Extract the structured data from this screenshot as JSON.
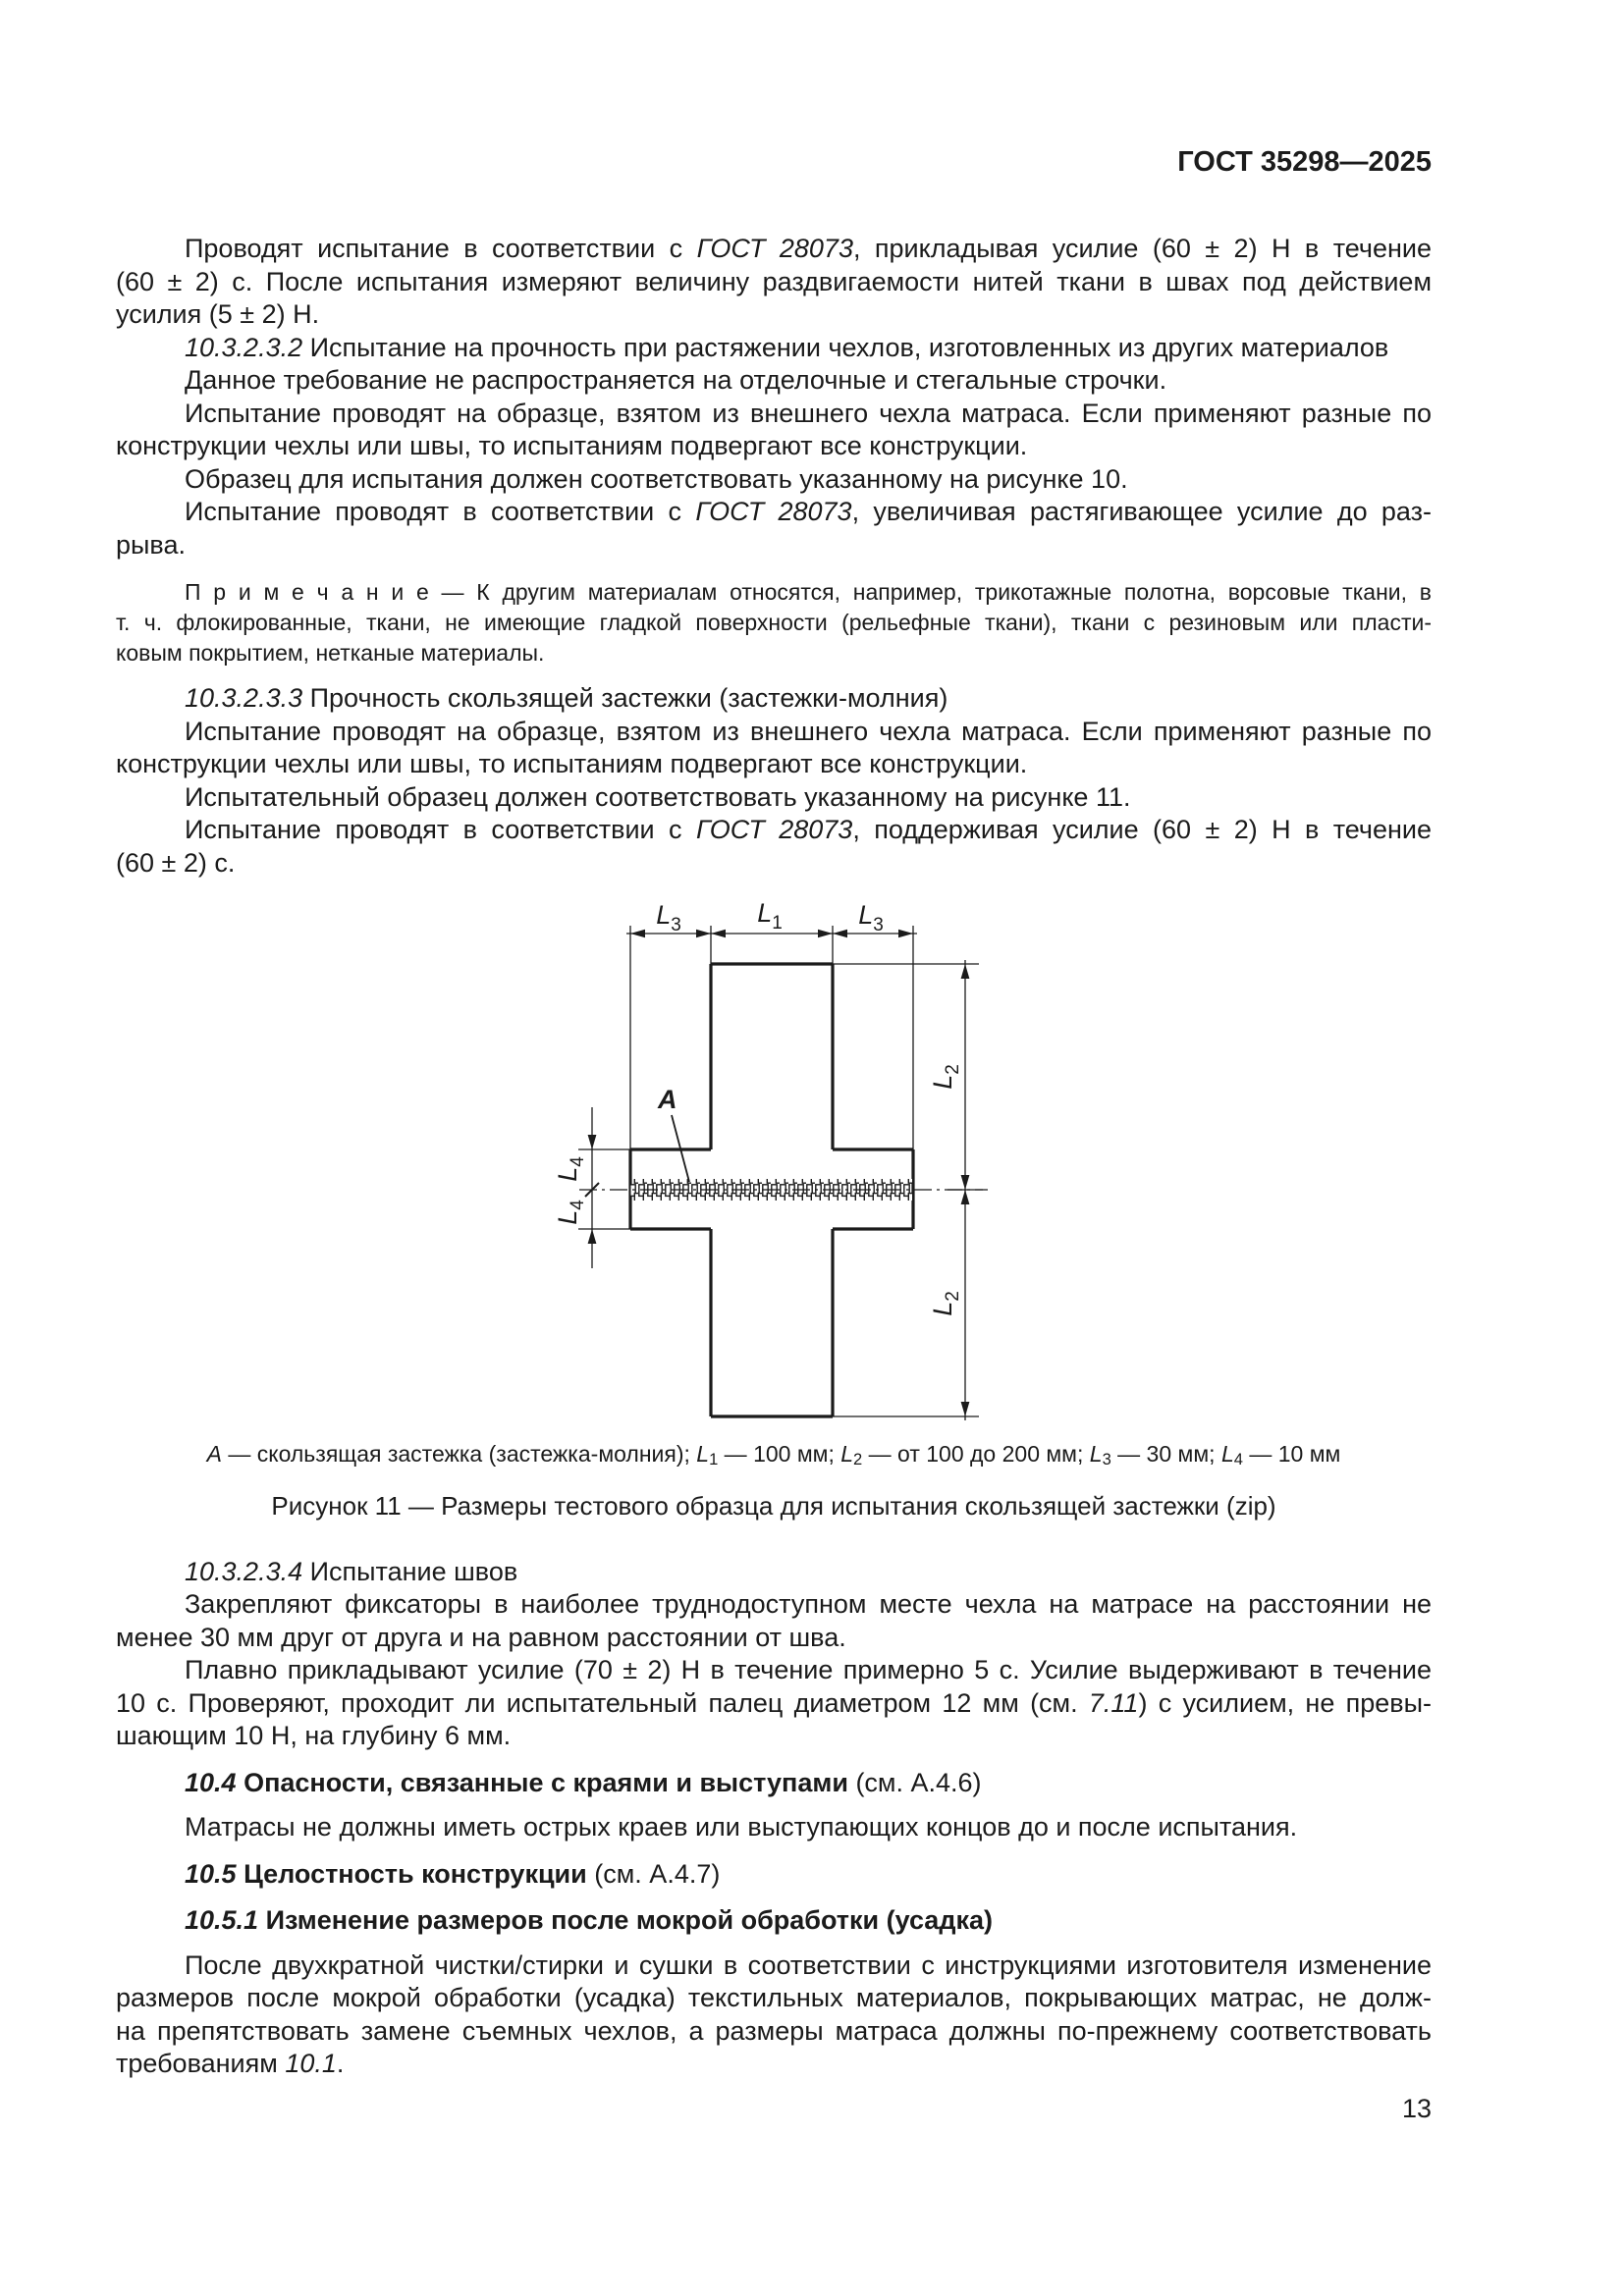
{
  "page": {
    "header_right": "ГОСТ 35298—2025",
    "page_number": "13"
  },
  "document": {
    "before_figure": [
      {
        "type": "p",
        "lines": [
          [
            [
              "r",
              "Проводят испытание в соответствии с "
            ],
            [
              "i",
              "ГОСТ 28073"
            ],
            [
              "r",
              ", прикладывая усилие (60 ± 2) Н в течение"
            ]
          ],
          [
            [
              "r",
              "(60 ± 2) с. После испытания измеряют величину раздвигаемости нитей ткани в швах под действием"
            ]
          ],
          [
            [
              "r",
              "усилия (5 ± 2) Н."
            ]
          ]
        ]
      },
      {
        "type": "p",
        "lines": [
          [
            [
              "i",
              "10.3.2.3.2"
            ],
            [
              "r",
              "  Испытание на прочность при растяжении чехлов, изготовленных из других материалов"
            ]
          ]
        ]
      },
      {
        "type": "p",
        "lines": [
          [
            [
              "r",
              "Данное требование не распространяется на отделочные и стегальные строчки."
            ]
          ]
        ]
      },
      {
        "type": "p",
        "lines": [
          [
            [
              "r",
              "Испытание проводят на образце, взятом из внешнего чехла матраса. Если применяют разные по"
            ]
          ],
          [
            [
              "r",
              "конструкции чехлы или швы, то испытаниям подвергают все конструкции."
            ]
          ]
        ]
      },
      {
        "type": "p",
        "lines": [
          [
            [
              "r",
              "Образец для испытания должен соответствовать указанному на рисунке 10."
            ]
          ]
        ]
      },
      {
        "type": "p",
        "lines": [
          [
            [
              "r",
              "Испытание проводят в соответствии с "
            ],
            [
              "i",
              "ГОСТ 28073"
            ],
            [
              "r",
              ", увеличивая растягивающее усилие до раз-"
            ]
          ],
          [
            [
              "r",
              "рыва."
            ]
          ]
        ]
      },
      {
        "type": "note",
        "lines": [
          [
            [
              "r",
              "П р и м е ч а н и е  — К другим материалам относятся, например, трикотажные полотна, ворсовые ткани, в"
            ]
          ],
          [
            [
              "r",
              "т. ч. флокированные, ткани, не имеющие гладкой поверхности (рельефные ткани), ткани с резиновым или пласти-"
            ]
          ],
          [
            [
              "r",
              "ковым покрытием, нетканые материалы."
            ]
          ]
        ]
      },
      {
        "type": "p",
        "lines": [
          [
            [
              "i",
              "10.3.2.3.3"
            ],
            [
              "r",
              "  Прочность скользящей застежки (застежки-молния)"
            ]
          ]
        ]
      },
      {
        "type": "p",
        "lines": [
          [
            [
              "r",
              "Испытание проводят на образце, взятом из внешнего чехла матраса. Если применяют разные по"
            ]
          ],
          [
            [
              "r",
              "конструкции чехлы или швы, то испытаниям подвергают все конструкции."
            ]
          ]
        ]
      },
      {
        "type": "p",
        "lines": [
          [
            [
              "r",
              "Испытательный образец должен соответствовать указанному на рисунке 11."
            ]
          ]
        ]
      },
      {
        "type": "p",
        "lines": [
          [
            [
              "r",
              "Испытание проводят в соответствии с "
            ],
            [
              "i",
              "ГОСТ 28073"
            ],
            [
              "r",
              ", поддерживая усилие (60 ± 2) Н в течение"
            ]
          ],
          [
            [
              "r",
              "(60 ± 2) с."
            ]
          ]
        ]
      }
    ],
    "after_figure": [
      {
        "type": "p",
        "lines": [
          [
            [
              "i",
              "10.3.2.3.4"
            ],
            [
              "r",
              "  Испытание швов"
            ]
          ]
        ]
      },
      {
        "type": "p",
        "lines": [
          [
            [
              "r",
              "Закрепляют фиксаторы в наиболее труднодоступном месте чехла на матрасе на расстоянии не"
            ]
          ],
          [
            [
              "r",
              "менее 30 мм друг от друга и на равном расстоянии от шва."
            ]
          ]
        ]
      },
      {
        "type": "p",
        "lines": [
          [
            [
              "r",
              "Плавно прикладывают усилие (70 ± 2) Н в течение примерно 5 с. Усилие выдерживают в течение"
            ]
          ],
          [
            [
              "r",
              "10 с. Проверяют, проходит ли испытательный палец диаметром 12 мм (см. "
            ],
            [
              "i",
              "7.11"
            ],
            [
              "r",
              ") с усилием, не превы-"
            ]
          ],
          [
            [
              "r",
              "шающим 10 Н, на глубину 6 мм."
            ]
          ]
        ]
      },
      {
        "type": "h",
        "lines": [
          [
            [
              "bi",
              "10.4"
            ],
            [
              "b",
              "  Опасности, связанные с краями и выступами "
            ],
            [
              "r",
              "(см. А.4.6)"
            ]
          ]
        ]
      },
      {
        "type": "p",
        "lines": [
          [
            [
              "r",
              "Матрасы не должны иметь острых краев или выступающих концов до и после испытания."
            ]
          ]
        ]
      },
      {
        "type": "h",
        "lines": [
          [
            [
              "bi",
              "10.5"
            ],
            [
              "b",
              "  Целостность конструкции "
            ],
            [
              "r",
              "(см. А.4.7)"
            ]
          ]
        ]
      },
      {
        "type": "h",
        "lines": [
          [
            [
              "bi",
              "10.5.1"
            ],
            [
              "b",
              "  Изменение размеров после мокрой обработки (усадка)"
            ]
          ]
        ]
      },
      {
        "type": "p",
        "lines": [
          [
            [
              "r",
              "После двухкратной чистки/стирки и сушки в соответствии с инструкциями изготовителя изменение"
            ]
          ],
          [
            [
              "r",
              "размеров после мокрой обработки (усадка) текстильных материалов, покрывающих матрас, не долж-"
            ]
          ],
          [
            [
              "r",
              "на препятствовать замене съемных чехлов, а размеры матраса должны по-прежнему соответствовать"
            ]
          ],
          [
            [
              "r",
              "требованиям "
            ],
            [
              "i",
              "10.1"
            ],
            [
              "r",
              "."
            ]
          ]
        ]
      }
    ]
  },
  "figure": {
    "label_a": "А",
    "symbol_L": "L",
    "subscript_1": "1",
    "subscript_2": "2",
    "subscript_3": "3",
    "subscript_4": "4",
    "caption_runs": [
      [
        "i",
        "А"
      ],
      [
        "r",
        " — скользящая застежка (застежка-молния); "
      ],
      [
        "i",
        "L"
      ],
      [
        "s",
        "1"
      ],
      [
        "r",
        " — 100 мм; "
      ],
      [
        "i",
        "L"
      ],
      [
        "s",
        "2"
      ],
      [
        "r",
        " — от 100 до 200 мм; "
      ],
      [
        "i",
        "L"
      ],
      [
        "s",
        "3"
      ],
      [
        "r",
        " — 30 мм; "
      ],
      [
        "i",
        "L"
      ],
      [
        "s",
        "4"
      ],
      [
        "r",
        " — 10 мм"
      ]
    ],
    "title": "Рисунок 11 — Размеры тестового образца для испытания скользящей застежки (zip)",
    "dimensions_note": {
      "L1_mm": "100",
      "L2_mm": "от 100 до 200",
      "L3_mm": "30",
      "L4_mm": "10"
    }
  }
}
